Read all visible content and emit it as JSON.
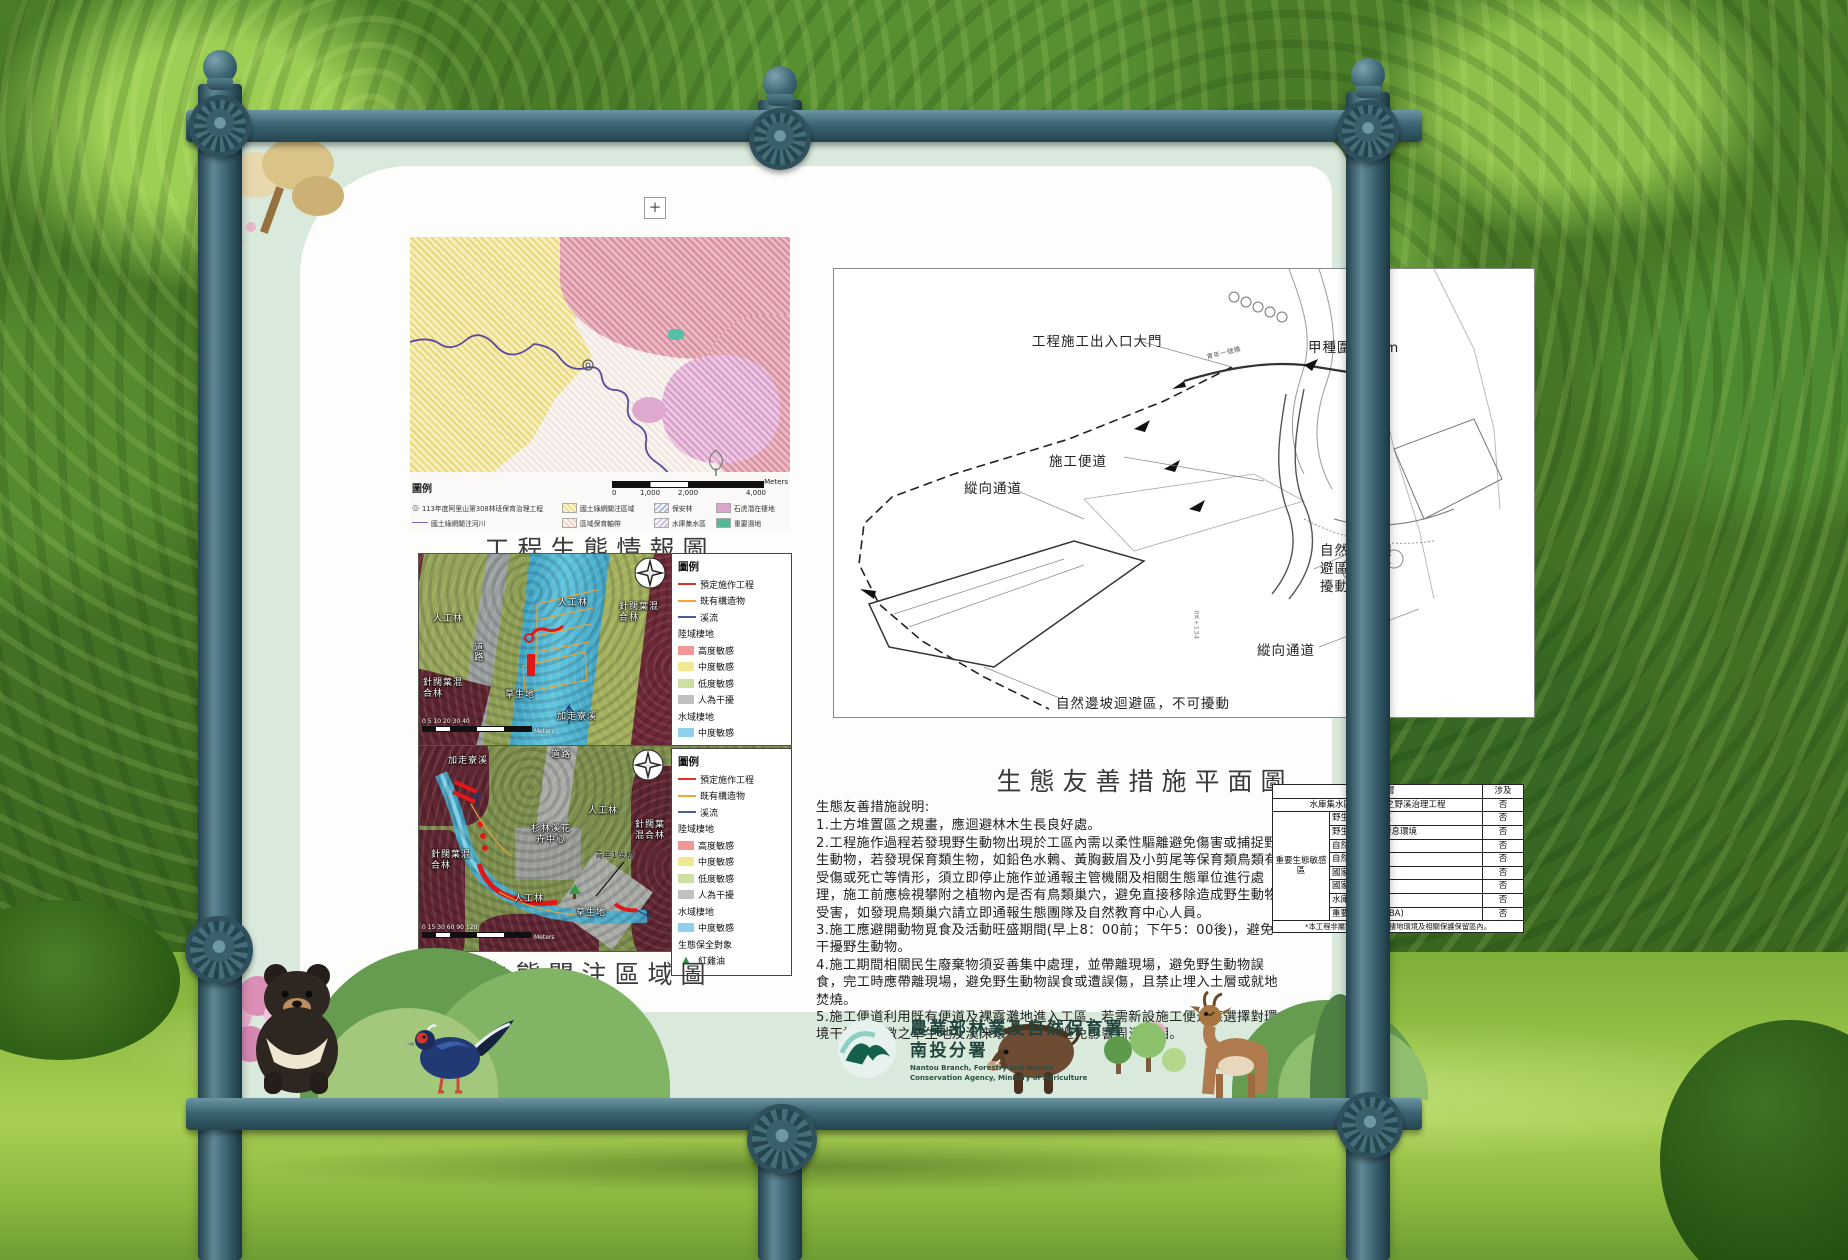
{
  "colors": {
    "frame": "#3c6573",
    "board": "#d9eadd",
    "panel": "#fdfdfc",
    "legend_high": "#f09898",
    "legend_mid": "#efe992",
    "legend_low": "#cbe0a2",
    "legend_human": "#c0c0c0",
    "legend_water": "#8fd0ee",
    "planned_line": "#e03128",
    "existing_line": "#f0a838",
    "stream_line": "#46609e",
    "wetland": "#52b896",
    "leopard_cat_habitat": "#d9a6ce"
  },
  "icons": {
    "project_marker": "◎",
    "tree_marker": "▲"
  },
  "map1": {
    "title": "工程生態情報圖",
    "zoom_control": "+",
    "legend_heading": "圖例",
    "legend": {
      "project": "113年度阿里山第308林班保育治理工程",
      "river": "國土綠網關注河川",
      "region": "國土綠網關注區域",
      "belt": "區域保育軸帶",
      "forest": "保安林",
      "reservoir": "水庫集水區",
      "leopard_cat": "石虎潛在棲地",
      "wetland": "重要濕地"
    },
    "scale": {
      "t0": "0",
      "t1": "1,000",
      "t2": "2,000",
      "t3": "4,000",
      "unit": "Meters"
    }
  },
  "aerial_legend": {
    "heading": "圖例",
    "planned": "預定施作工程",
    "existing": "既有構造物",
    "stream": "溪流",
    "land_heading": "陸域棲地",
    "high": "高度敏感",
    "mid": "中度敏感",
    "low": "低度敏感",
    "human": "人為干擾",
    "water_heading": "水域棲地",
    "water_mid": "中度敏感",
    "conserve_heading": "生態保全對象",
    "conserve_item": "紅雞油"
  },
  "map2": {
    "labels": {
      "plantation_top": "人工林",
      "mixed_right": "針闊葉混合林",
      "plantation_left": "人工林",
      "road": "道路",
      "mixed_left": "針闊葉混合林",
      "grass": "草生地",
      "stream": "加走寮溪"
    },
    "scale": {
      "ticks": "0 5 10   20   30   40",
      "unit": "Meters"
    }
  },
  "map3": {
    "title": "生態關注區域圖",
    "labels": {
      "stream": "加走寮溪",
      "road": "道路",
      "plantation_right": "人工林",
      "mixed_right": "針闊葉混合林",
      "center": "杉林溪花卉中心",
      "bridge": "青年1號橋",
      "mixed_left": "針闊葉混合林",
      "plantation_bottom": "人工林",
      "grass": "草生地"
    },
    "scale": {
      "ticks": "0 15 30   60   90   120",
      "unit": "Meters"
    }
  },
  "plan": {
    "title": "生態友善措施平面圖",
    "labels": {
      "gate": "工程施工出入口大門",
      "fence": "甲種圍籬55m",
      "temp_road": "施工便道",
      "passage1": "縱向通道",
      "avoid1": "自然邊坡迴避區，不可擾動",
      "passage2": "縱向通道",
      "avoid2": "自然邊坡迴避區，不可擾動",
      "bridge": "青年一號橋",
      "station": "0K+134"
    }
  },
  "notes": {
    "heading": "生態友善措施說明:",
    "item1": "1.土方堆置區之規畫，應迴避林木生長良好處。",
    "item2": "2.工程施作過程若發現野生動物出現於工區內需以柔性驅離避免傷害或捕捉野生動物，若發現保育類生物，如鉛色水鶇、黃胸藪眉及小剪尾等保育類鳥類有受傷或死亡等情形，須立即停止施作並通報主管機關及相關生態單位進行處理，施工前應檢視攀附之植物內是否有鳥類巢穴，避免直接移除造成野生動物受害，如發現鳥類巢穴請立即通報生態團隊及自然教育中心人員。",
    "item3": "3.施工應避開動物覓食及活動旺盛期間(早上8：00前；下午5：00後)，避免干擾野生動物。",
    "item4": "4.施工期間相關民生廢棄物須妥善集中處理，並帶離現場，避免野生動物誤食，完工時應帶離現場，避免野生動物誤食或遭誤傷，且禁止埋入土層或就地焚燒。",
    "item5": "5.施工便道利用既有便道及裸露灘地進入工區，若需新設施工便道應選擇對環境干擾較輕微之草生地及溪床環境開設，避免影響周邊林相。"
  },
  "table": {
    "header_layer": "套疊圖層",
    "header_involved": "涉及",
    "project": "水庫集水區保安林地之野溪治理工程",
    "project_involved": "否",
    "group": "重要生態敏感區",
    "rows": {
      "r1": {
        "label": "野生動物保護區",
        "v": "否"
      },
      "r2": {
        "label": "野生動物重要棲息環境",
        "v": "否"
      },
      "r3": {
        "label": "自然保留區",
        "v": "否"
      },
      "r4": {
        "label": "自然保護區",
        "v": "否"
      },
      "r5": {
        "label": "國家(自然)公園",
        "v": "否"
      },
      "r6": {
        "label": "國家重要濕地",
        "v": "否"
      },
      "r7": {
        "label": "水庫蓄水範圍",
        "v": "否"
      },
      "r8": {
        "label": "重要野鳥棲地(IBA)",
        "v": "否"
      }
    },
    "footnote": "*本工程非屬野生動物重要棲地環境及相關保護保留區內。"
  },
  "logo": {
    "org_zh": "農業部林業及自然保育署",
    "branch_zh": "南投分署",
    "org_en_1": "Nantou Branch, Forestry and Nature",
    "org_en_2": "Conservation Agency, Ministry of Agriculture"
  }
}
